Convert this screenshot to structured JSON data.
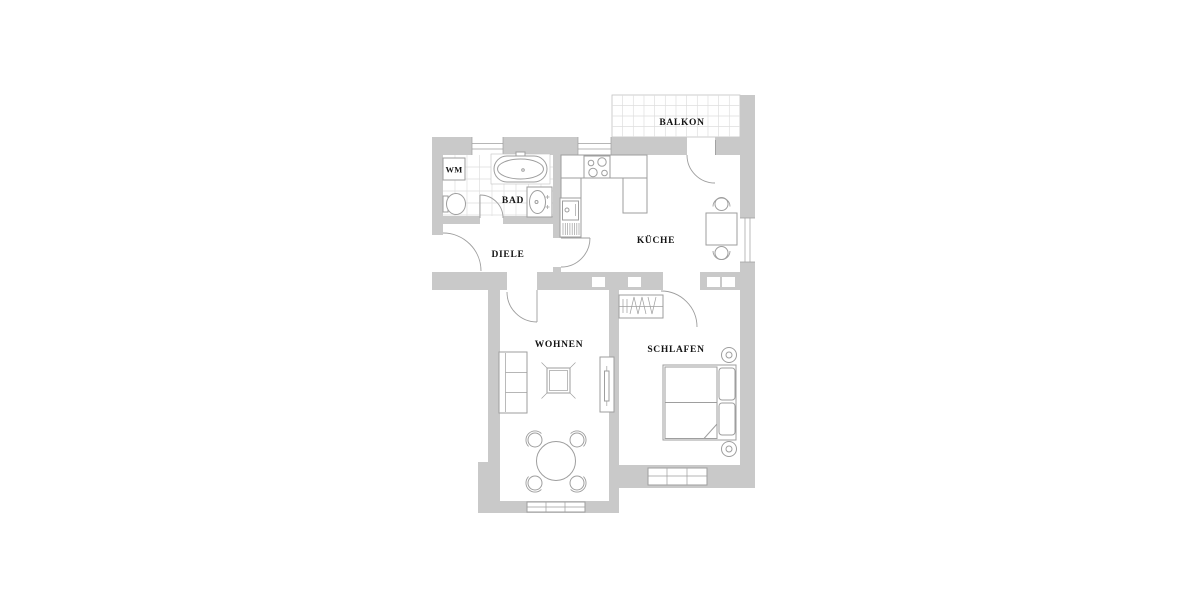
{
  "plan": {
    "type": "apartment-floor-plan",
    "labels": {
      "balcony": "BALKON",
      "washing_machine": "WM",
      "bathroom": "BAD",
      "hallway": "DIELE",
      "kitchen": "KÜCHE",
      "living_room": "WOHNEN",
      "bedroom": "SCHLAFEN"
    },
    "colors": {
      "wall": "#c9c9c9",
      "line": "#9e9e9e",
      "faint": "#c2c2c2",
      "tile": "#dedede",
      "text": "#141414",
      "background": "#ffffff"
    }
  }
}
